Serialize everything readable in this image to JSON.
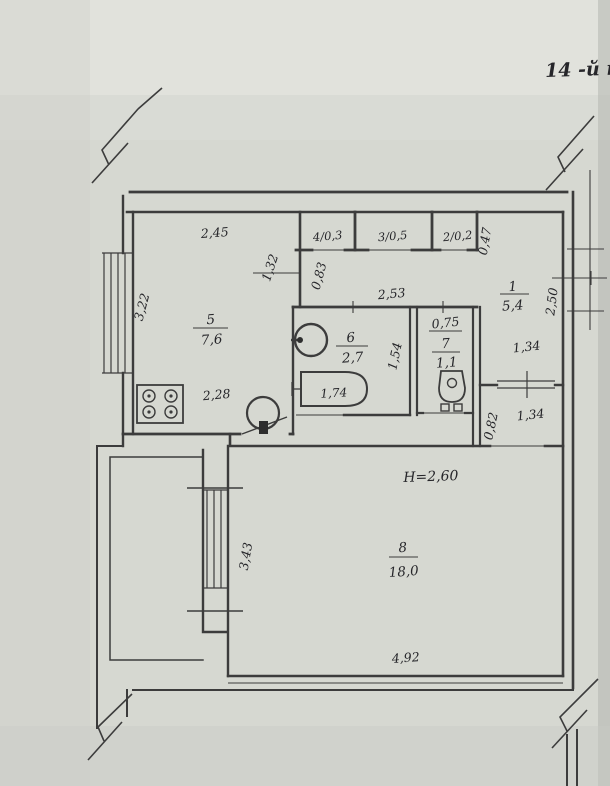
{
  "colors": {
    "paper": "#d6d8d1",
    "ink": "#3c3c3c",
    "text": "#26262a"
  },
  "title": "14 -й п",
  "ceiling_note": "H=2,60",
  "rooms": {
    "kitchen": {
      "num": "5",
      "area": "7,6"
    },
    "bathroom": {
      "num": "6",
      "area": "2,7"
    },
    "toilet": {
      "num": "7",
      "area": "1,1"
    },
    "hall": {
      "num": "1",
      "area": "5,4"
    },
    "living": {
      "num": "8",
      "area": "18,0"
    },
    "closet4": {
      "label": "4/0,3"
    },
    "closet3": {
      "label": "3/0,5"
    },
    "closet2": {
      "label": "2/0,2"
    }
  },
  "dims": {
    "kitchen_top": "2,45",
    "kitchen_side": "3,22",
    "kitchen_bottom": "2,28",
    "corridor": "1,32",
    "stub": "0,83",
    "bath_block_top": "2,53",
    "closet_side": "0,47",
    "toilet_top": "0,75",
    "hall_side": "2,50",
    "hall_door": "1,34",
    "bath_side": "1,54",
    "bathtub": "1,74",
    "entry_side": "0,82",
    "entry_door": "1,34",
    "living_side": "3,43",
    "living_bottom": "4,92"
  }
}
